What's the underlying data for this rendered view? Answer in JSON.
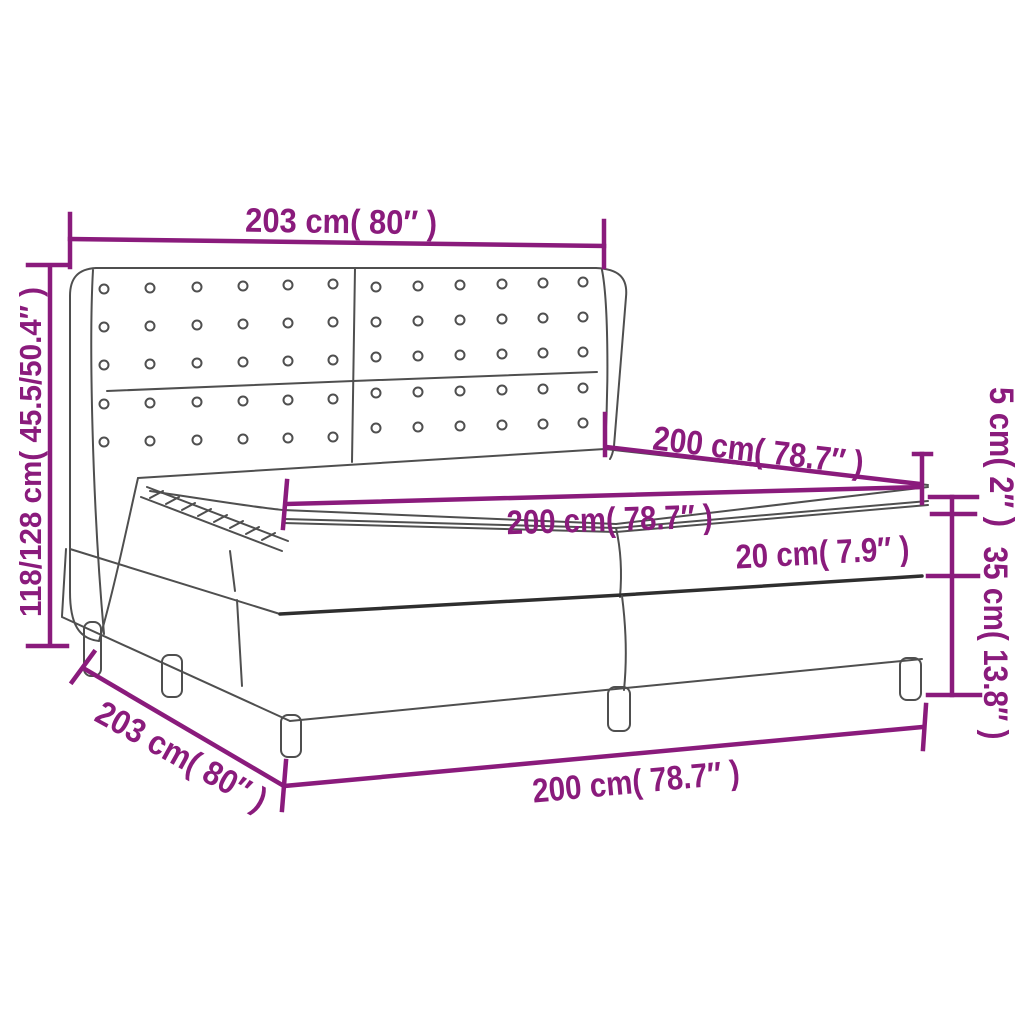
{
  "figure": {
    "subject": "box-spring-bed-with-wing-tufted-headboard-line-drawing",
    "accent_color": "#8a1b7c",
    "outline_color": "#4f4f4f",
    "background_color": "#ffffff"
  },
  "labels": {
    "headboard_width": "203 cm( 80″ )",
    "total_height": "118/128 cm( 45.5/50.4″ )",
    "depth_top": "200 cm( 78.7″ )",
    "mattress_width": "200 cm( 78.7″ )",
    "mattress_thickness": "20 cm( 7.9″ )",
    "topper_thickness": "5 cm( 2″ )",
    "base_height": "35 cm( 13.8″ )",
    "frame_depth": "203 cm( 80″ )",
    "base_width": "200 cm( 78.7″ )"
  }
}
